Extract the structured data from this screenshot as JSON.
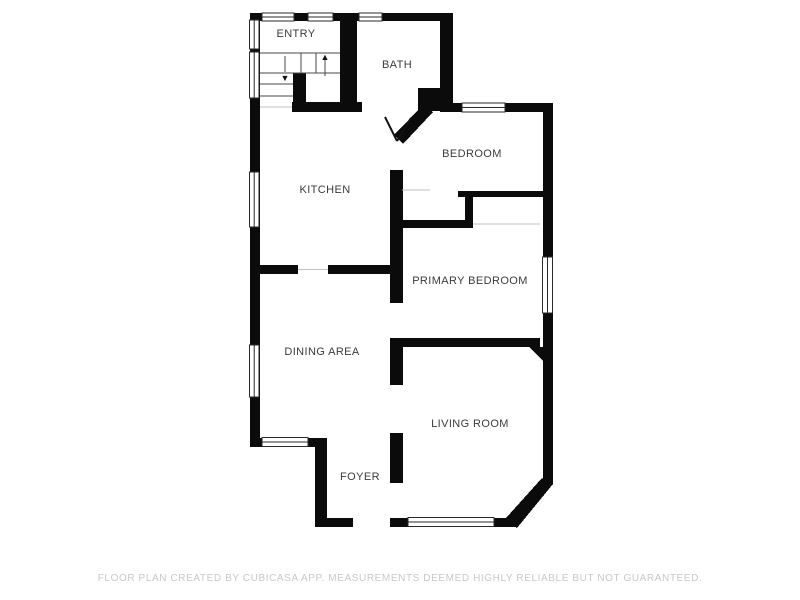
{
  "floor_plan": {
    "wall_color": "#0b0b0b",
    "label_color": "#3b3b3b",
    "rooms": {
      "entry": "ENTRY",
      "bath": "BATH",
      "bedroom": "BEDROOM",
      "kitchen": "KITCHEN",
      "primary_bedroom": "PRIMARY BEDROOM",
      "dining_area": "DINING AREA",
      "living_room": "LIVING ROOM",
      "foyer": "FOYER"
    },
    "symbols": {
      "stairs_up_arrow": "▲",
      "stairs_down_arrow": "▼"
    }
  },
  "footer": {
    "disclaimer": "FLOOR PLAN CREATED BY CUBICASA APP. MEASUREMENTS DEEMED HIGHLY RELIABLE BUT NOT GUARANTEED.",
    "color": "#c8c8c8"
  }
}
